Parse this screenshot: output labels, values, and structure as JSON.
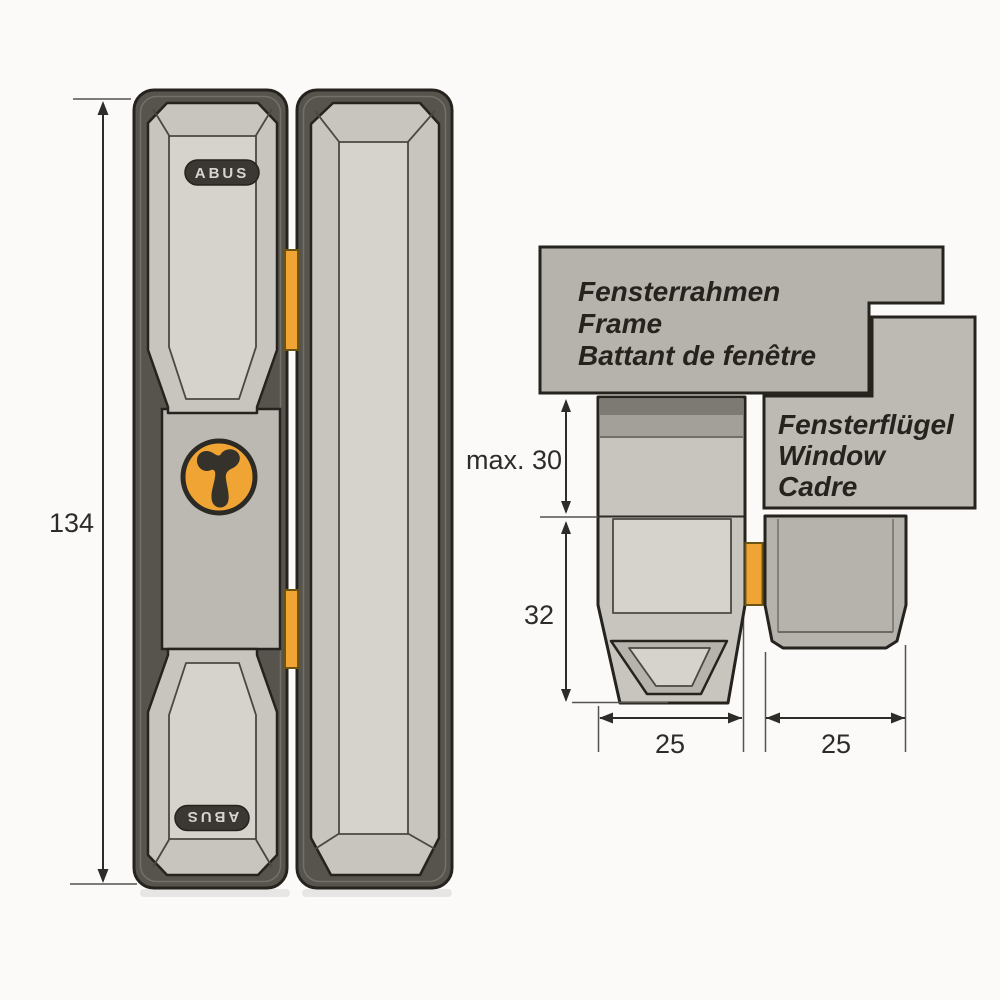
{
  "front_view": {
    "height_label": "134",
    "badge_top": "ABUS",
    "badge_bottom": "ABUS"
  },
  "cross_section": {
    "frame_label": {
      "de": "Fensterrahmen",
      "en": "Frame",
      "fr": "Battant de fenêtre"
    },
    "sash_label": {
      "de": "Fensterflügel",
      "en": "Window",
      "fr": "Cadre"
    },
    "dims": {
      "overlap": "max. 30",
      "height": "32",
      "width_lock": "25",
      "width_strike": "25"
    }
  },
  "colors": {
    "bg": "#fbfaf8",
    "outline": "#26231e",
    "body_dark": "#57544e",
    "panel_light": "#c8c5bf",
    "panel_lighter": "#d6d3cd",
    "panel_mid": "#bcb9b3",
    "badge_bg": "#3b3833",
    "badge_text": "#d8d5cf",
    "orange": "#f0a433",
    "orange_stroke": "#6b5413",
    "box_gray": "#b6b3ad",
    "box_gray_light": "#bdbab4",
    "band_dark": "#7d7a74",
    "band_mid": "#a3a09a",
    "dim": "#2e2c29",
    "thin": "#55534e",
    "bevel": "#4a4843",
    "ring": "#73706a"
  }
}
